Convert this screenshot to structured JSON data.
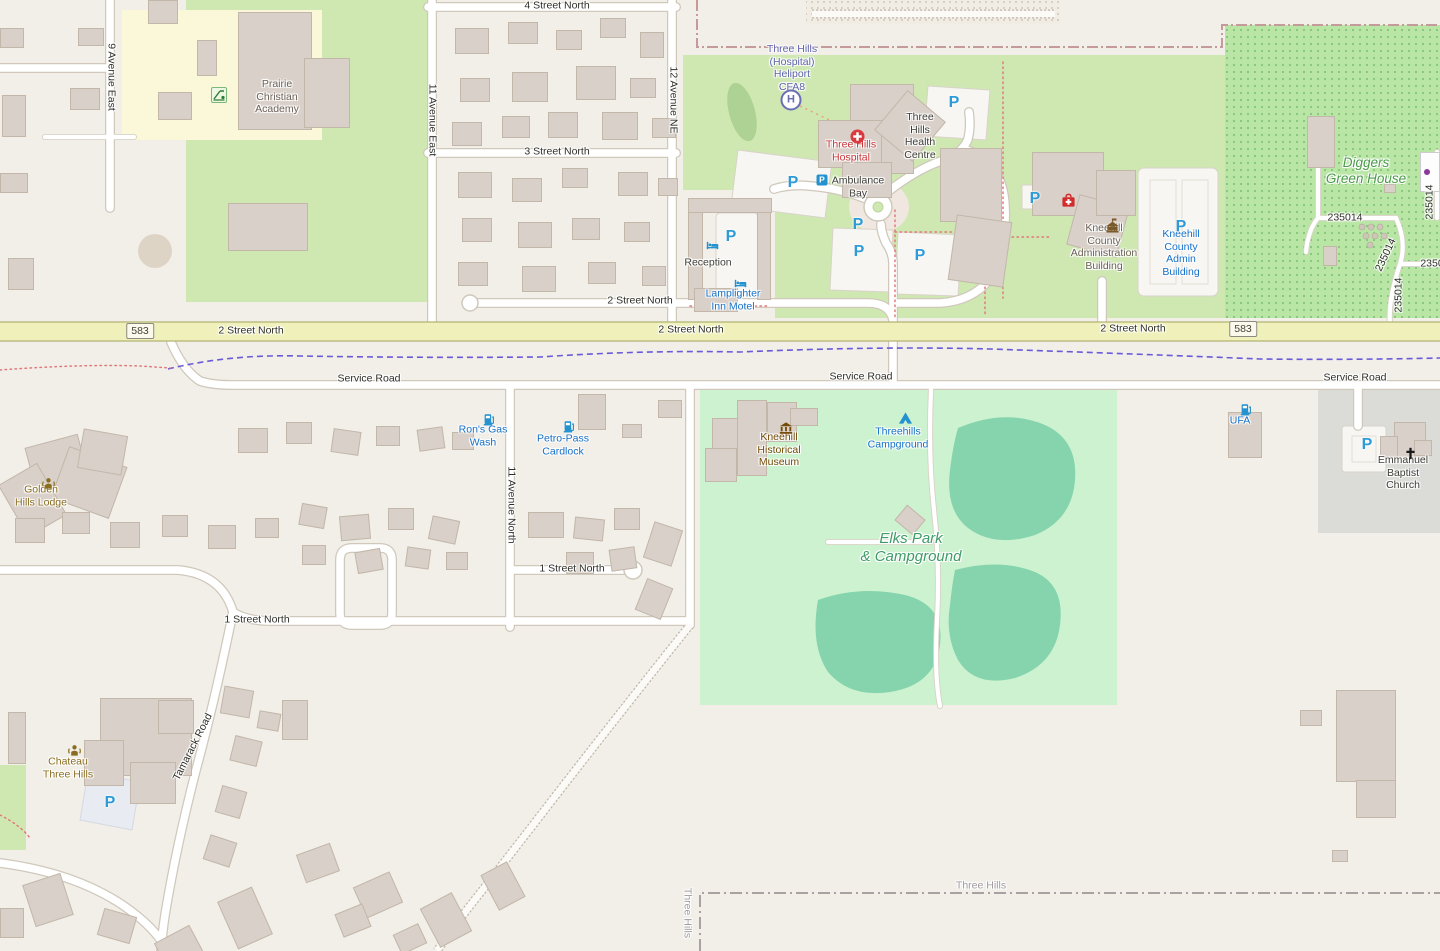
{
  "map_labels": {
    "streets": {
      "street4": "4 Street North",
      "street3": "3 Street North",
      "street2": "2 Street North",
      "street1": "1 Street North",
      "ave9": "9 Avenue East",
      "ave11e": "11 Avenue East",
      "ave12ne": "12 Avenue NE",
      "ave11n": "11 Avenue North",
      "service_road": "Service Road",
      "tamarack": "Tamarack Road",
      "shield583": "583",
      "twp235014": "235014",
      "twp2350": "2350"
    },
    "boundary": {
      "three_hills": "Three Hills"
    },
    "pois": {
      "academy": [
        "Prairie",
        "Christian",
        "Academy"
      ],
      "heliport": [
        "Three Hills",
        "(Hospital)",
        "Heliport",
        "CFA8"
      ],
      "hospital": [
        "Three Hills",
        "Hospital"
      ],
      "health_centre": [
        "Three",
        "Hills",
        "Health",
        "Centre"
      ],
      "ambulance_bay": [
        "Ambulance",
        "Bay"
      ],
      "reception": [
        "Reception"
      ],
      "lamplighter": [
        "Lamplighter",
        "Inn Motel"
      ],
      "admin_building": [
        "Kneehill",
        "County",
        "Administration",
        "Building"
      ],
      "admin_parking": [
        "Kneehill",
        "County",
        "Admin",
        "Building"
      ],
      "diggers": [
        "Diggers",
        "Green House"
      ],
      "rons_gas": [
        "Ron's Gas",
        "Wash"
      ],
      "petro_pass": [
        "Petro-Pass",
        "Cardlock"
      ],
      "golden_hills": [
        "Golden",
        "Hills Lodge"
      ],
      "museum": [
        "Kneehill",
        "Historical",
        "Museum"
      ],
      "campground": [
        "Threehills",
        "Campground"
      ],
      "elks_park": [
        "Elks Park",
        "& Campground"
      ],
      "ufa": [
        "UFA"
      ],
      "church": [
        "Emmanuel",
        "Baptist",
        "Church"
      ],
      "chateau": [
        "Chateau",
        "Three Hills"
      ]
    },
    "icons": {
      "parking_letter": "P",
      "heliport_letter": "H"
    }
  },
  "colors": {
    "land": "#f2efe9",
    "campus_green": "#cfe8b2",
    "park_green": "#ccf2cf",
    "nursery_green": "#b9e6a4",
    "pond_teal": "#85d4ad",
    "school_yellow": "#fbf8d9",
    "major_road_yellow": "#f0f1ba",
    "building_beige": "#d9d0c9",
    "parking_blue": "#2e9bd6",
    "poi_blue": "#1470c8",
    "poi_brown": "#734a08",
    "poi_red": "#cb3439",
    "aeroway_purple": "#5f63ac",
    "park_label_green": "#3f9b68",
    "boundary_purple": "#6a5ad8"
  },
  "map_geometry": {
    "roads": [
      {
        "d": "M110,0 V208"
      },
      {
        "d": "M0,68 H106"
      },
      {
        "d": "M432,0 V323"
      },
      {
        "d": "M672,0 V323"
      },
      {
        "d": "M428,7 H676"
      },
      {
        "d": "M428,153 H676"
      },
      {
        "d": "M474,303 H868 Q890,303 893,320"
      },
      {
        "d": "M171,342 Q183,370 200,381 Q212,385 232,385 H1440"
      },
      {
        "d": "M893,341 V385"
      },
      {
        "d": "M510,385 V627"
      },
      {
        "d": "M690,385 V625"
      },
      {
        "d": "M510,570 H624"
      },
      {
        "d": "M0,570 H178 Q222,574 233,612"
      },
      {
        "d": "M233,612 Q246,621 272,621 H690"
      },
      {
        "d": "M233,612 Q215,700 196,770 Q176,848 165,915 Q162,935 161,951"
      },
      {
        "d": "M690,625 Q630,700 560,790 Q510,855 455,925 L437,951",
        "t": "g"
      },
      {
        "d": "M0,863 Q70,872 118,902 Q152,924 166,948"
      },
      {
        "d": "M893,322 V263 Q893,253 886,243 Q881,232 881,224"
      },
      {
        "d": "M885,194 Q915,170 941,161 Q963,153 968,139 Q971,127 969,112"
      },
      {
        "d": "M864,198 Q838,188 810,186 Q790,184 774,189"
      },
      {
        "d": "M967,150 Q1003,163 1005,206 Q1007,252 989,280 Q972,301 940,303 H896"
      },
      {
        "d": "M1102,281 V323"
      },
      {
        "d": "M1358,385 V426"
      },
      {
        "d": "M352,548 H380 Q392,548 392,560 V613 Q392,625 380,625 H352 Q340,625 340,613 V560 Q340,548 352,548 Z"
      },
      {
        "d": "M931,390 Q928,455 934,510 Q940,565 937,620 Q934,675 940,706",
        "t": "n"
      },
      {
        "d": "M828,542 H931",
        "t": "n"
      },
      {
        "d": "M1318,128 V218",
        "t": "n"
      },
      {
        "d": "M1318,218 H1396",
        "t": "n"
      },
      {
        "d": "M1396,218 Q1407,242 1400,264",
        "t": "n"
      },
      {
        "d": "M1400,264 Q1388,300 1390,323",
        "t": "n"
      },
      {
        "d": "M1400,264 H1440",
        "t": "n"
      },
      {
        "d": "M1318,218 Q1308,230 1306,252",
        "t": "n"
      },
      {
        "d": "M1437,152 V218",
        "t": "n"
      },
      {
        "d": "M45,137 H134",
        "t": "n"
      },
      {
        "d": "M812,14 H1055",
        "t": "g"
      }
    ],
    "buildings": [
      [
        0,
        28,
        24,
        20
      ],
      [
        78,
        28,
        26,
        18
      ],
      [
        148,
        0,
        30,
        24
      ],
      [
        2,
        95,
        24,
        42
      ],
      [
        70,
        88,
        30,
        22
      ],
      [
        158,
        92,
        34,
        28
      ],
      [
        0,
        173,
        28,
        20
      ],
      [
        8,
        258,
        26,
        32
      ],
      [
        238,
        12,
        74,
        118
      ],
      [
        304,
        58,
        46,
        70
      ],
      [
        197,
        40,
        20,
        36
      ],
      [
        228,
        203,
        80,
        48
      ],
      [
        455,
        28,
        34,
        26
      ],
      [
        508,
        22,
        30,
        22
      ],
      [
        556,
        30,
        26,
        20
      ],
      [
        600,
        18,
        26,
        20
      ],
      [
        640,
        32,
        24,
        26
      ],
      [
        460,
        78,
        30,
        24
      ],
      [
        512,
        72,
        36,
        30
      ],
      [
        576,
        66,
        40,
        34
      ],
      [
        630,
        78,
        26,
        20
      ],
      [
        452,
        122,
        30,
        24
      ],
      [
        502,
        116,
        28,
        22
      ],
      [
        548,
        112,
        30,
        26
      ],
      [
        602,
        112,
        36,
        28
      ],
      [
        652,
        118,
        24,
        20
      ],
      [
        458,
        172,
        34,
        26
      ],
      [
        512,
        178,
        30,
        24
      ],
      [
        562,
        168,
        26,
        20
      ],
      [
        618,
        172,
        30,
        24
      ],
      [
        658,
        178,
        20,
        18
      ],
      [
        462,
        218,
        30,
        24
      ],
      [
        518,
        222,
        34,
        26
      ],
      [
        572,
        218,
        28,
        22
      ],
      [
        624,
        222,
        26,
        20
      ],
      [
        458,
        262,
        30,
        24
      ],
      [
        522,
        266,
        34,
        26
      ],
      [
        588,
        262,
        28,
        22
      ],
      [
        642,
        266,
        24,
        20
      ],
      [
        850,
        84,
        64,
        90
      ],
      [
        818,
        120,
        64,
        48
      ],
      [
        885,
        100,
        50,
        52,
        40
      ],
      [
        842,
        162,
        50,
        36
      ],
      [
        940,
        148,
        62,
        74
      ],
      [
        952,
        218,
        56,
        66,
        8
      ],
      [
        1032,
        152,
        72,
        64
      ],
      [
        1072,
        200,
        52,
        52,
        15
      ],
      [
        1096,
        170,
        40,
        46
      ],
      [
        688,
        198,
        84,
        15
      ],
      [
        688,
        212,
        15,
        88
      ],
      [
        757,
        212,
        14,
        88
      ],
      [
        694,
        288,
        44,
        24
      ],
      [
        1307,
        116,
        28,
        52
      ],
      [
        1420,
        152,
        20,
        40,
        0,
        1
      ],
      [
        1384,
        184,
        12,
        9
      ],
      [
        1323,
        246,
        14,
        20
      ],
      [
        1228,
        412,
        34,
        46
      ],
      [
        1394,
        422,
        32,
        38
      ],
      [
        1380,
        436,
        18,
        22
      ],
      [
        1414,
        440,
        18,
        16
      ],
      [
        737,
        400,
        30,
        76
      ],
      [
        712,
        418,
        26,
        48
      ],
      [
        767,
        402,
        30,
        40
      ],
      [
        790,
        408,
        28,
        18
      ],
      [
        705,
        448,
        32,
        34
      ],
      [
        898,
        510,
        24,
        20,
        40
      ],
      [
        30,
        440,
        55,
        50,
        -15
      ],
      [
        58,
        455,
        62,
        55,
        20
      ],
      [
        10,
        470,
        45,
        60,
        -30
      ],
      [
        80,
        432,
        45,
        40,
        10
      ],
      [
        15,
        518,
        30,
        25
      ],
      [
        62,
        512,
        28,
        22
      ],
      [
        110,
        522,
        30,
        26
      ],
      [
        162,
        515,
        26,
        22
      ],
      [
        208,
        525,
        28,
        24
      ],
      [
        255,
        518,
        24,
        20
      ],
      [
        238,
        428,
        30,
        25
      ],
      [
        286,
        422,
        26,
        22
      ],
      [
        332,
        430,
        28,
        24,
        8
      ],
      [
        376,
        426,
        24,
        20
      ],
      [
        418,
        428,
        26,
        22,
        -8
      ],
      [
        452,
        432,
        22,
        18
      ],
      [
        300,
        505,
        26,
        22,
        10
      ],
      [
        340,
        515,
        30,
        25,
        -5
      ],
      [
        388,
        508,
        26,
        22
      ],
      [
        430,
        518,
        28,
        24,
        12
      ],
      [
        302,
        545,
        24,
        20
      ],
      [
        356,
        550,
        26,
        22,
        -10
      ],
      [
        406,
        548,
        24,
        20,
        8
      ],
      [
        446,
        552,
        22,
        18
      ],
      [
        528,
        512,
        36,
        26
      ],
      [
        574,
        518,
        30,
        22,
        6
      ],
      [
        614,
        508,
        26,
        22
      ],
      [
        648,
        525,
        30,
        38,
        18
      ],
      [
        610,
        548,
        26,
        22,
        -8
      ],
      [
        566,
        552,
        28,
        22
      ],
      [
        640,
        582,
        28,
        34,
        22
      ],
      [
        578,
        394,
        28,
        36
      ],
      [
        658,
        400,
        24,
        18
      ],
      [
        622,
        424,
        20,
        14
      ],
      [
        100,
        698,
        92,
        78
      ],
      [
        84,
        740,
        40,
        46
      ],
      [
        130,
        762,
        46,
        42
      ],
      [
        158,
        700,
        36,
        34
      ],
      [
        8,
        712,
        18,
        52
      ],
      [
        222,
        688,
        30,
        28,
        10
      ],
      [
        232,
        738,
        28,
        26,
        14
      ],
      [
        218,
        788,
        26,
        28,
        16
      ],
      [
        206,
        838,
        28,
        26,
        18
      ],
      [
        258,
        712,
        22,
        18,
        10
      ],
      [
        282,
        700,
        26,
        40
      ],
      [
        300,
        848,
        36,
        30,
        -20
      ],
      [
        358,
        878,
        40,
        34,
        -24
      ],
      [
        428,
        898,
        36,
        44,
        -28
      ],
      [
        488,
        866,
        30,
        40,
        -28
      ],
      [
        338,
        908,
        30,
        25,
        -22
      ],
      [
        396,
        928,
        28,
        22,
        -25
      ],
      [
        28,
        878,
        40,
        44,
        -18
      ],
      [
        100,
        912,
        34,
        28,
        16
      ],
      [
        0,
        908,
        24,
        30
      ],
      [
        160,
        932,
        40,
        36,
        -28
      ],
      [
        226,
        892,
        38,
        52,
        -24
      ],
      [
        1336,
        690,
        60,
        92
      ],
      [
        1356,
        780,
        40,
        38
      ],
      [
        1300,
        710,
        22,
        16
      ],
      [
        1332,
        850,
        16,
        12
      ]
    ]
  }
}
